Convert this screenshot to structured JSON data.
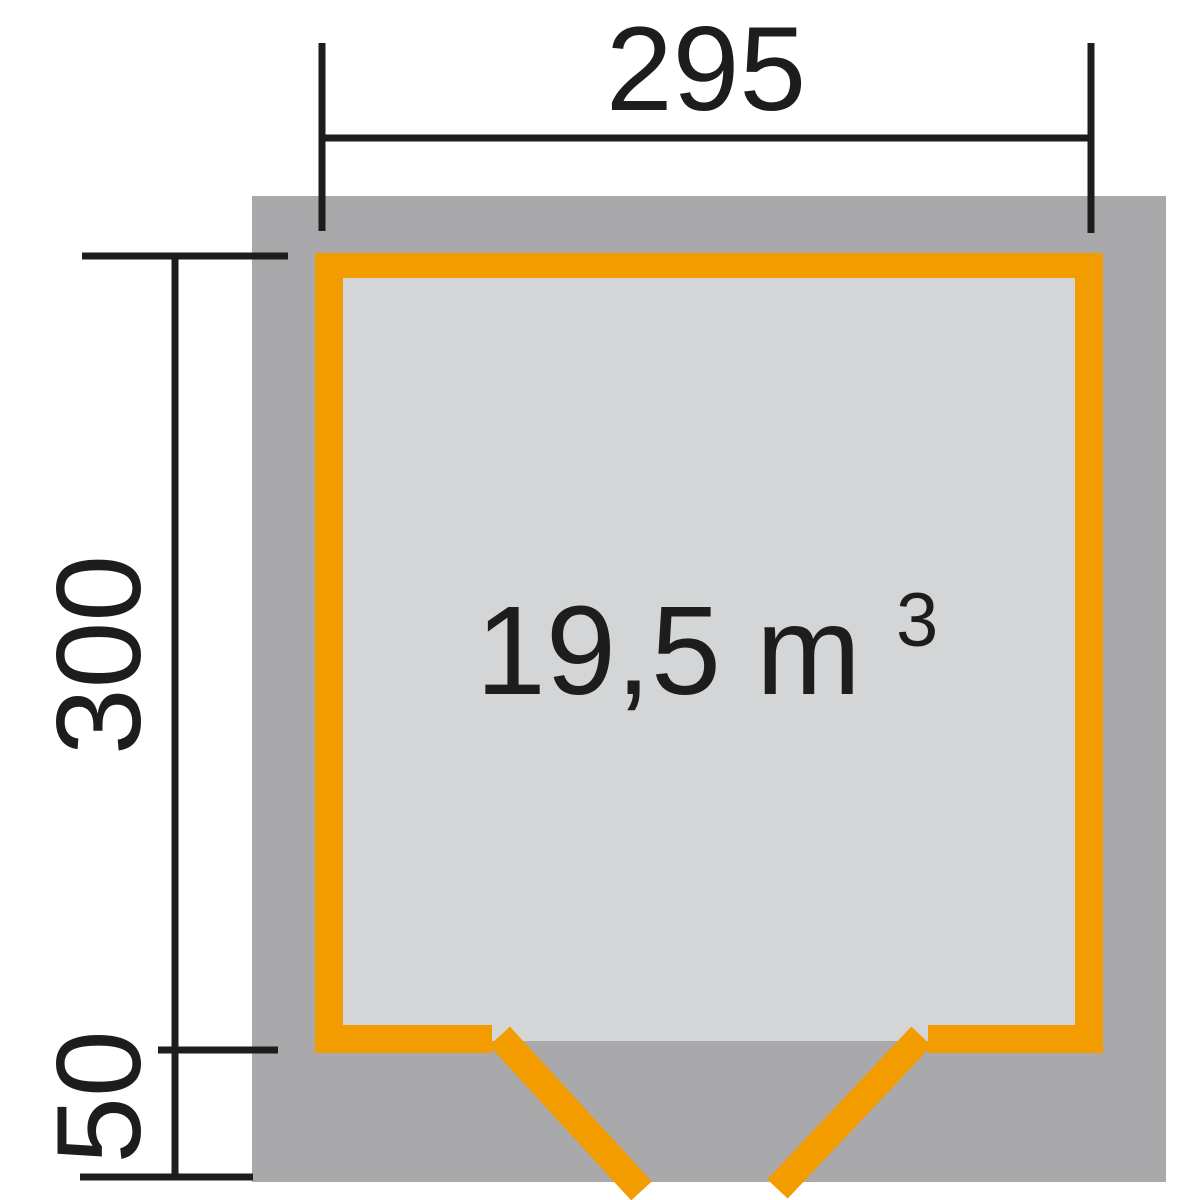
{
  "dimensions": {
    "width": "295",
    "depth": "300",
    "front_overhang": "50"
  },
  "volume": {
    "value": "19,5 m",
    "exponent": "3"
  },
  "colors": {
    "wall_orange": "#F39C00",
    "roof_overhang_gray": "#A9A9AB",
    "floor_gray": "#D3D5D6",
    "line_black": "#1D1D1B",
    "background": "#FFFFFF"
  }
}
